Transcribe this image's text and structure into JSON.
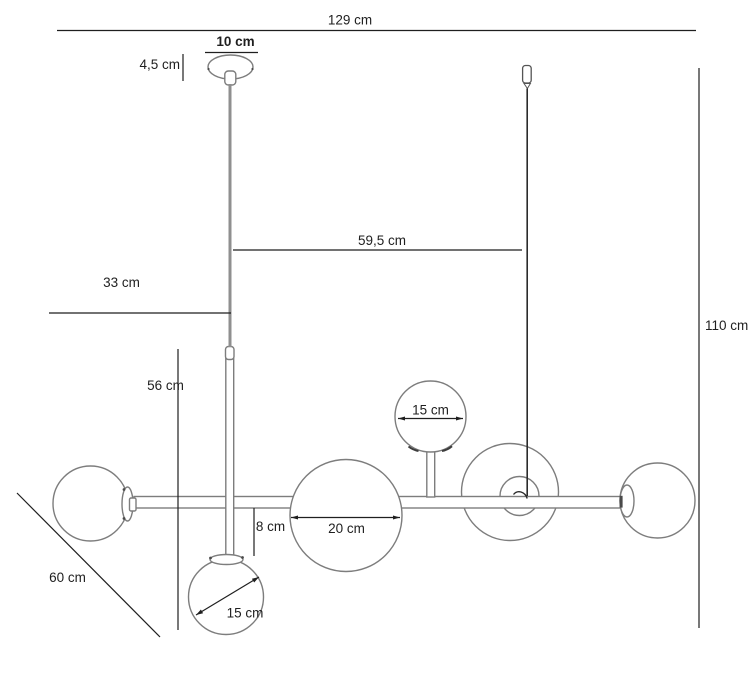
{
  "drawing": {
    "colors": {
      "background": "#ffffff",
      "fixture_outline": "#7d7d7d",
      "dimension_lines": "#1f1f1f",
      "suspension_wire": "#8f8f8f",
      "suspension_cord": "#2b2b2b"
    },
    "labels": {
      "total_width": "129 cm",
      "canopy_diameter": "10 cm",
      "canopy_height": "4,5 cm",
      "cord_offset": "59,5 cm",
      "left_overhang": "33 cm",
      "stem_height": "56 cm",
      "total_height": "110 cm",
      "depth": "60 cm",
      "globe_drop": "8 cm",
      "large_globe_diameter": "20 cm",
      "top_globe_diameter": "15 cm",
      "bottom_globe_diameter": "15 cm"
    }
  }
}
